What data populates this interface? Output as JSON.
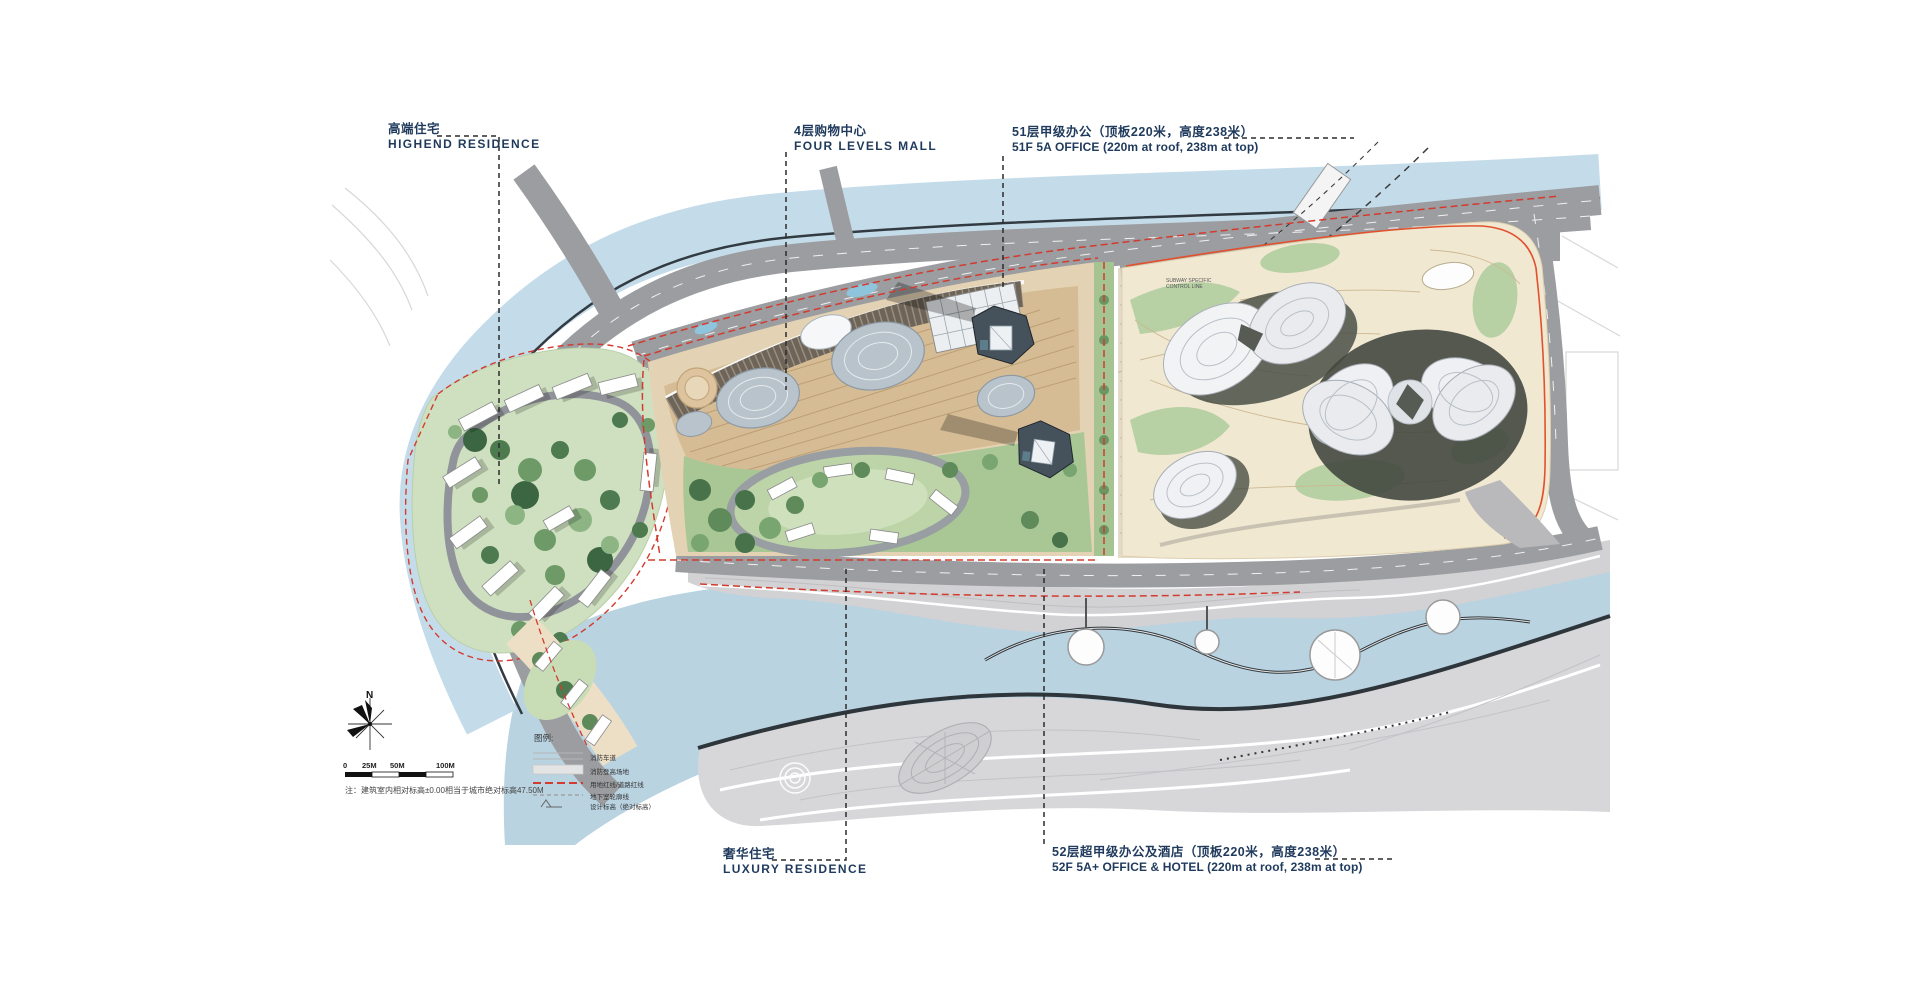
{
  "annotations": {
    "highend_residence": {
      "cn": "高端住宅",
      "en": "HIGHEND RESIDENCE"
    },
    "four_levels_mall": {
      "cn": "4层购物中心",
      "en": "FOUR LEVELS MALL"
    },
    "office_51f": {
      "cn": "51层甲级办公（顶板220米，高度238米）",
      "en": "51F 5A OFFICE (220m at roof, 238m at top)"
    },
    "luxury_residence": {
      "cn": "奢华住宅",
      "en": "LUXURY RESIDENCE"
    },
    "office_hotel_52f": {
      "cn": "52层超甲级办公及酒店（顶板220米，高度238米）",
      "en": "52F 5A+ OFFICE & HOTEL (220m at roof, 238m at top)"
    }
  },
  "legend": {
    "title": "图例:",
    "items": [
      {
        "label": "消防车道",
        "swatch": "fire-lane-lines"
      },
      {
        "label": "消防登高场地",
        "swatch": "gray-area"
      },
      {
        "label": "用地红线/道路红线",
        "swatch": "red-dashed-line"
      },
      {
        "label": "地下室轮廓线",
        "swatch": "gray-dashed-line"
      },
      {
        "label": "设计标高（绝对标高）",
        "swatch": "spot-level-mark"
      }
    ]
  },
  "scale_bar": {
    "labels": [
      "0",
      "25M",
      "50M",
      "100M"
    ]
  },
  "north_label": "N",
  "note": "注：建筑室内相对标高±0.00相当于城市绝对标高47.50M",
  "map_texts": {
    "subway_line1": "SUBWAY SPECIFIC",
    "subway_line2": "CONTROL LINE"
  },
  "colors": {
    "water": "#b9d3e1",
    "river": "#c4dcea",
    "road": "#9c9da0",
    "residence_green": "#cfe0c0",
    "plaza_tan": "#d6bc95",
    "park_cream": "#f1e8d2",
    "red_line": "#d23b2f",
    "label_text": "#1f3a5c"
  }
}
